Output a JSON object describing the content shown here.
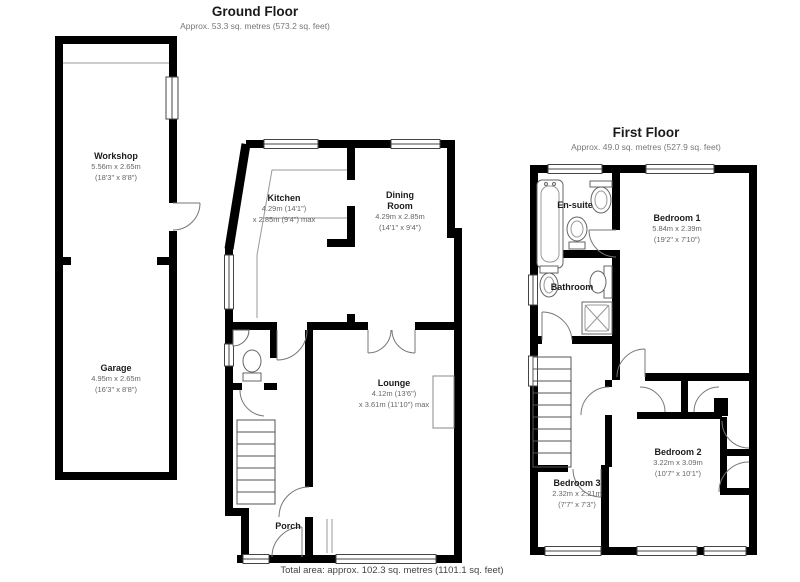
{
  "colors": {
    "walls": "#000000",
    "background": "#ffffff",
    "dim_text": "#666666"
  },
  "ground_floor": {
    "title": "Ground Floor",
    "subtitle": "Approx. 53.3 sq. metres (573.2 sq. feet)",
    "rooms": {
      "kitchen": {
        "name": "Kitchen",
        "dim1": "4.29m (14'1\")",
        "dim2": "x 2.85m (9'4\") max"
      },
      "dining_room": {
        "name1": "Dining",
        "name2": "Room",
        "dim1": "4.29m x 2.85m",
        "dim2": "(14'1\" x 9'4\")"
      },
      "lounge": {
        "name": "Lounge",
        "dim1": "4.12m (13'6\")",
        "dim2": "x 3.61m (11'10\") max"
      },
      "porch": {
        "name": "Porch"
      }
    }
  },
  "first_floor": {
    "title": "First Floor",
    "subtitle": "Approx. 49.0 sq. metres (527.9 sq. feet)",
    "rooms": {
      "en_suite": {
        "name": "En-suite"
      },
      "bedroom1": {
        "name": "Bedroom 1",
        "dim1": "5.84m x 2.39m",
        "dim2": "(19'2\" x 7'10\")"
      },
      "bathroom": {
        "name": "Bathroom"
      },
      "bedroom2": {
        "name": "Bedroom 2",
        "dim1": "3.22m x 3.09m",
        "dim2": "(10'7\" x 10'1\")"
      },
      "bedroom3": {
        "name": "Bedroom 3",
        "dim1": "2.32m x 2.21m",
        "dim2": "(7'7\" x 7'3\")"
      }
    }
  },
  "outbuilding": {
    "rooms": {
      "workshop": {
        "name": "Workshop",
        "dim1": "5.56m x 2.65m",
        "dim2": "(18'3\" x 8'8\")"
      },
      "garage": {
        "name": "Garage",
        "dim1": "4.95m x 2.65m",
        "dim2": "(16'3\" x 8'8\")"
      }
    }
  },
  "footer": {
    "total_area": "Total area: approx. 102.3 sq. metres (1101.1 sq. feet)"
  }
}
